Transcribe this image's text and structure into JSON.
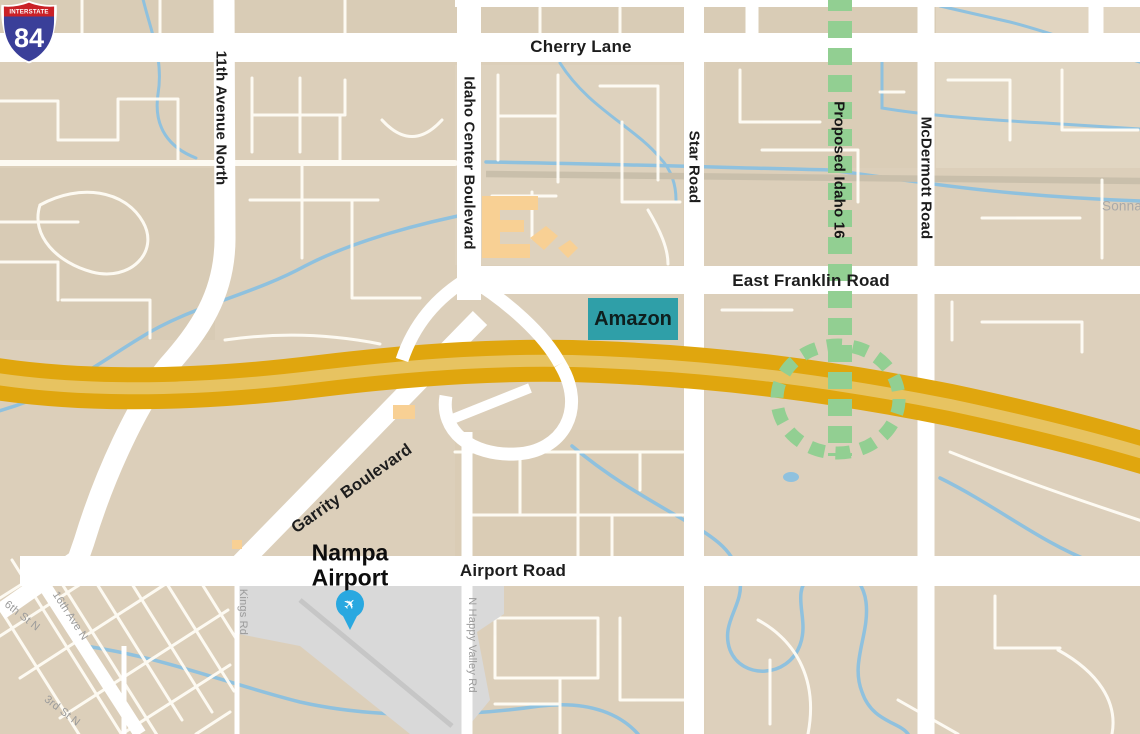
{
  "road_labels": {
    "cherry_lane": "Cherry Lane",
    "eleventh_avenue_north": "11th Avenue North",
    "idaho_center_boulevard": "Idaho Center Boulevard",
    "star_road": "Star Road",
    "mcdermott_road": "McDermott Road",
    "east_franklin_road": "East Franklin Road",
    "garrity_boulevard": "Garrity Boulevard",
    "airport_road": "Airport Road",
    "kings_road": "Kings Rd",
    "n_happy_valley_road": "N Happy Valley Rd",
    "sixth_street_n": "6th St N",
    "sixteenth_avenue_n": "16th Ave N",
    "third_street_n": "3rd St N",
    "sonna_road_partial": "Sonna"
  },
  "markers": {
    "amazon_label": "Amazon",
    "airport_name_line1": "Nampa",
    "airport_name_line2": "Airport",
    "interstate_shield_top": "INTERSTATE",
    "interstate_shield_number": "84",
    "proposed_route_label": "Proposed Idaho 16"
  },
  "colors": {
    "land": "#dccfba",
    "road_white": "#ffffff",
    "interstate_gold": "#e0a60e",
    "interstate_center_stripe": "#e7c361",
    "proposed_route_green": "#92cf92",
    "water_blue": "#8fc1de",
    "amazon_teal": "#2f9fa8",
    "airport_gray": "#d9d9d9",
    "building_orange": "#f8d094",
    "shield_red": "#ca2127",
    "shield_blue": "#3a3f99",
    "pin_blue": "#29a8e0",
    "minor_label_gray": "#9b9b9b"
  }
}
